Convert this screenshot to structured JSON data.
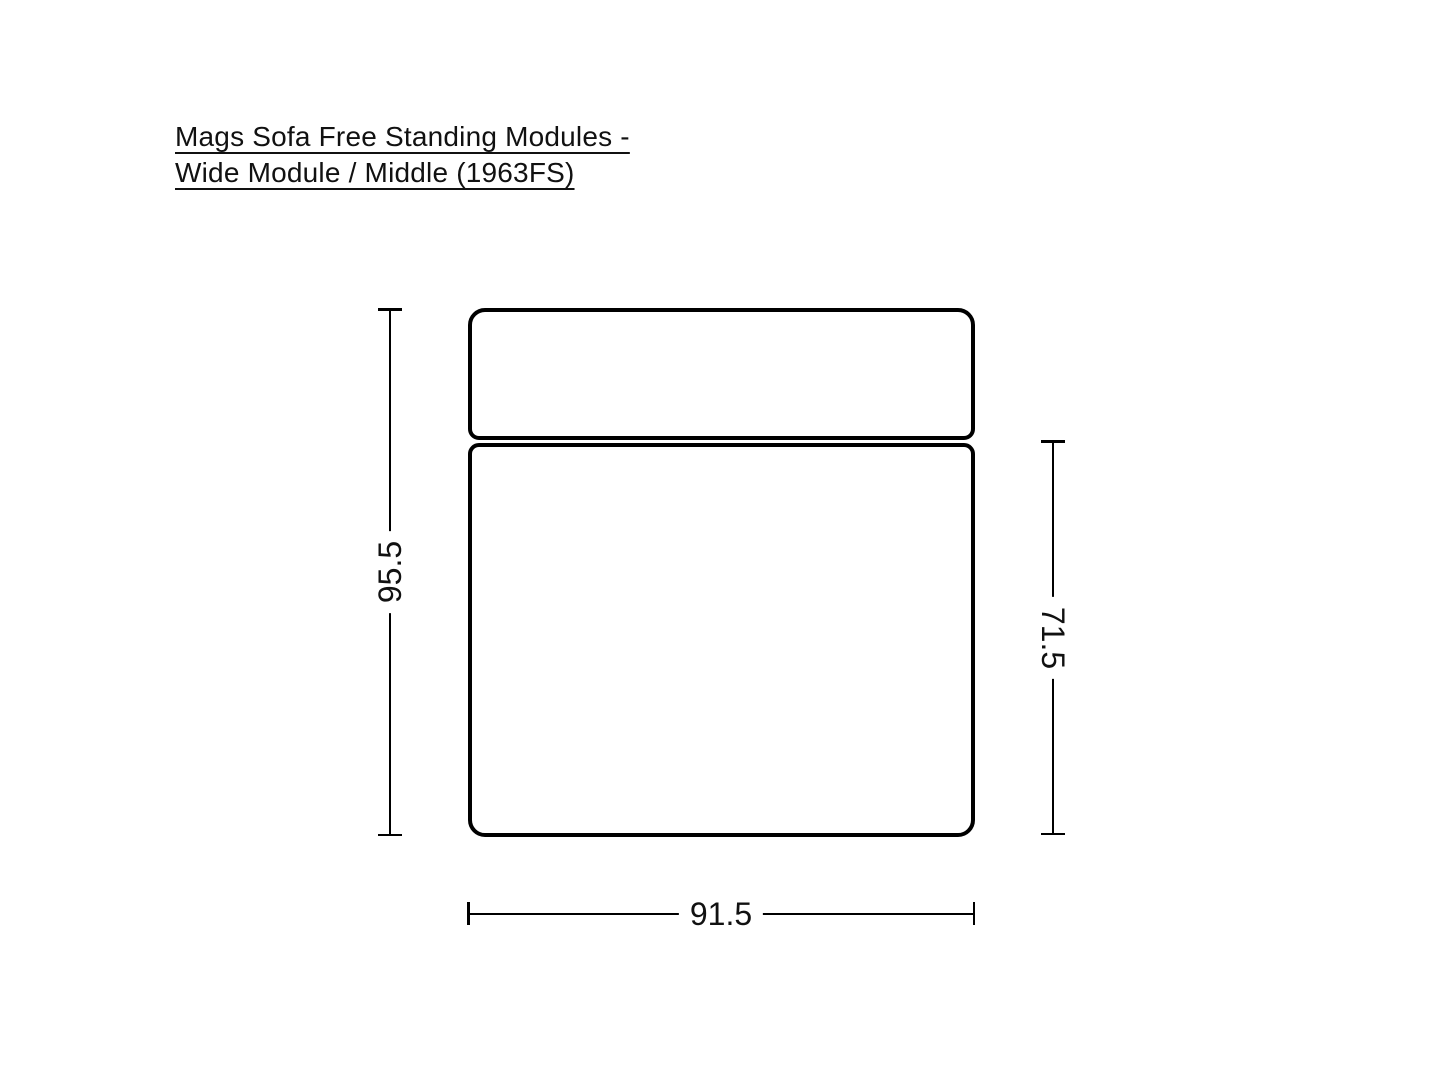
{
  "page": {
    "background_color": "#ffffff",
    "stroke_color": "#000000",
    "text_color": "#111111"
  },
  "title": {
    "line1": "Mags Sofa Free Standing Modules -",
    "line2": "Wide Module / Middle (1963FS)"
  },
  "diagram": {
    "type": "product-dimension-drawing",
    "view": "top-view-sofa-module",
    "parts": [
      "backrest",
      "seat-cushion"
    ],
    "dimensions": {
      "overall_depth": "95.5",
      "seat_depth": "71.5",
      "width": "91.5"
    }
  }
}
